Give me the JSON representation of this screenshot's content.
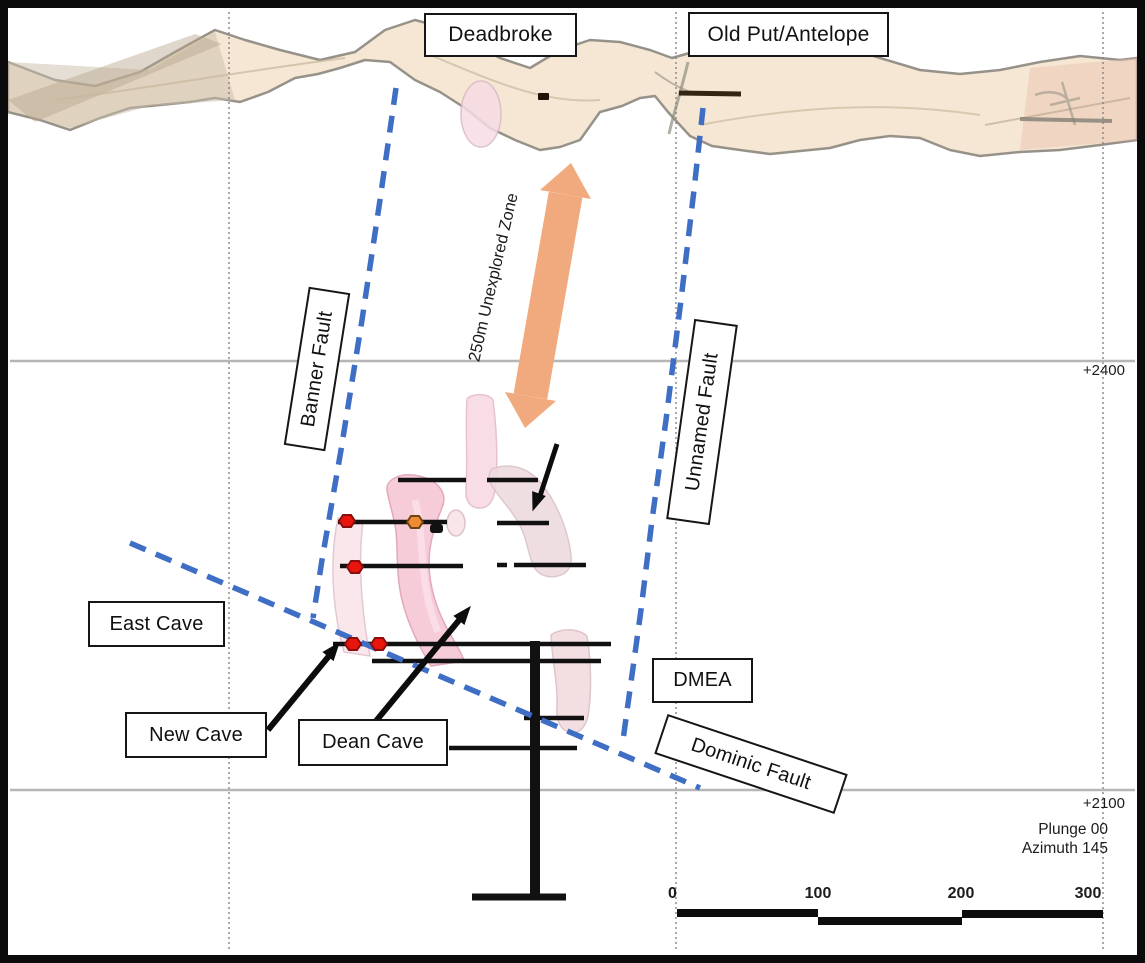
{
  "diagram": {
    "surface_labels": {
      "deadbroke": "Deadbroke",
      "old_put_antelope": "Old Put/Antelope"
    },
    "faults": {
      "banner": "Banner Fault",
      "unnamed": "Unnamed Fault",
      "dominic": "Dominic Fault"
    },
    "caves": {
      "east": "East Cave",
      "new": "New Cave",
      "dean": "Dean Cave",
      "dmea": "DMEA"
    },
    "annotations": {
      "unexplored_zone": "250m Unexplored Zone",
      "elev_upper": "+2400",
      "elev_lower": "+2100",
      "plunge": "Plunge 00",
      "azimuth": "Azimuth 145"
    },
    "scale_bar": {
      "ticks": [
        "0",
        "100",
        "200",
        "300"
      ]
    },
    "colors": {
      "fault_line_blue": "#3f6ec5",
      "unexplored_arrow_orange": "#f1aa7e",
      "ore_body_pink": "#f6ccd8",
      "ore_body_pale_pink": "#fae6ec",
      "marker_red": "#e8150d",
      "marker_orange": "#ef8b33",
      "terrain_tan": "#f3e3cb",
      "drill_line_black": "#111111",
      "gridline_gray": "#b6b6b6"
    },
    "markers": {
      "red_hexagons": 4,
      "orange_hexagons": 1
    }
  }
}
